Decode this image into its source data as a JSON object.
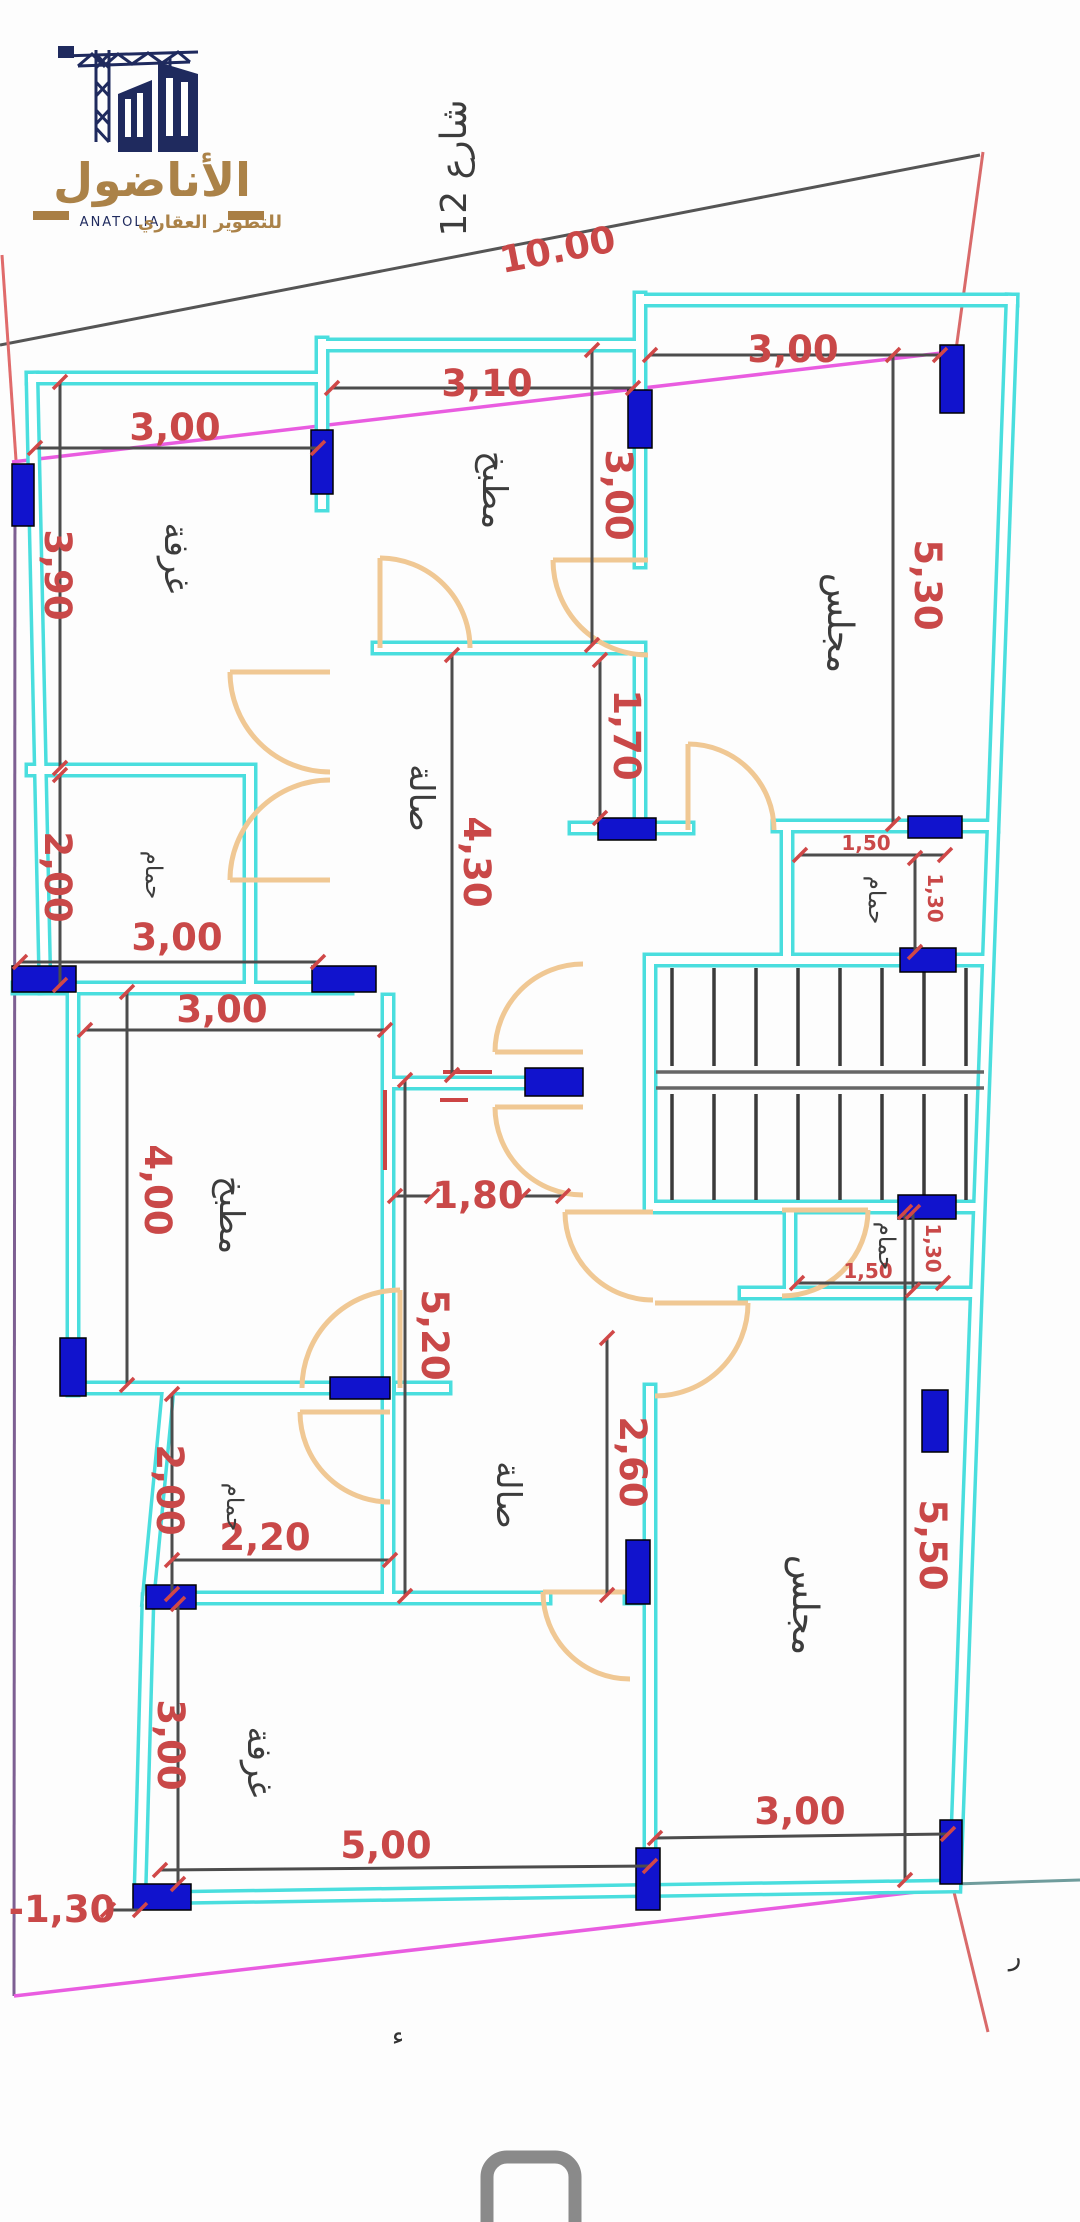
{
  "logo": {
    "brand_ar": "الأناضول",
    "tagline_ar": "للتطوير العقاري",
    "brand_en": "ANATOLIA"
  },
  "street": {
    "label": "شارع 12"
  },
  "colors": {
    "wall": "#4adede",
    "column": "#1113cd",
    "dimension_text": "#c94848",
    "dimension_line": "#4c4c4c",
    "door": "#f0c894",
    "boundary_magenta": "#e95ce0",
    "boundary_purple": "#7d5f92",
    "boundary_red": "#e06b6b",
    "navy": "#1f2a5e",
    "gold": "#ab8248"
  },
  "rooms": [
    {
      "id": "bedroom-top-left",
      "label": "غرفة"
    },
    {
      "id": "kitchen-top",
      "label": "مطبخ"
    },
    {
      "id": "majlis-top",
      "label": "مجلس"
    },
    {
      "id": "hall-upper",
      "label": "صالة"
    },
    {
      "id": "bath-upper-left",
      "label": "حمام"
    },
    {
      "id": "bath-upper-right",
      "label": "حمام"
    },
    {
      "id": "kitchen-lower",
      "label": "مطبخ"
    },
    {
      "id": "bath-lower-left",
      "label": "حمام"
    },
    {
      "id": "hall-lower",
      "label": "صالة"
    },
    {
      "id": "bath-lower-right",
      "label": "حمام"
    },
    {
      "id": "bedroom-bottom",
      "label": "غرفة"
    },
    {
      "id": "majlis-bottom",
      "label": "مجلس"
    }
  ],
  "dims": [
    {
      "id": "street-frontage",
      "label": "10.00"
    },
    {
      "id": "bedroom-tl-width",
      "label": "3,00"
    },
    {
      "id": "kitchen-top-width",
      "label": "3,10"
    },
    {
      "id": "majlis-top-width",
      "label": "3,00"
    },
    {
      "id": "majlis-top-height",
      "label": "5,30"
    },
    {
      "id": "bedroom-tl-height",
      "label": "3,90"
    },
    {
      "id": "kitchen-top-height",
      "label": "3,00"
    },
    {
      "id": "hall-majlis-gap",
      "label": "1,70"
    },
    {
      "id": "hall-upper-height",
      "label": "4,30"
    },
    {
      "id": "bath-ul-height",
      "label": "2,00"
    },
    {
      "id": "left-wall-width",
      "label": "3,00"
    },
    {
      "id": "kitchen-lower-width",
      "label": "3,00"
    },
    {
      "id": "kitchen-lower-height",
      "label": "4,00"
    },
    {
      "id": "corridor-width",
      "label": "1,80"
    },
    {
      "id": "hall-lower-height",
      "label": "5,20"
    },
    {
      "id": "hall-lower-right-height",
      "label": "2,60"
    },
    {
      "id": "bath-ll-height",
      "label": "2,00"
    },
    {
      "id": "bath-ll-width",
      "label": "2,20"
    },
    {
      "id": "majlis-bottom-height",
      "label": "5,50"
    },
    {
      "id": "bedroom-b-height",
      "label": "3,00"
    },
    {
      "id": "bedroom-b-width",
      "label": "5,00"
    },
    {
      "id": "majlis-bottom-width",
      "label": "3,00"
    },
    {
      "id": "setback",
      "label": "-1,30"
    },
    {
      "id": "bath-ur-width",
      "label": "1,50"
    },
    {
      "id": "bath-ur-height",
      "label": "1,30"
    },
    {
      "id": "bath-lr-width",
      "label": "1,50"
    },
    {
      "id": "bath-lr-height",
      "label": "1,30"
    }
  ],
  "marks": [
    {
      "id": "stray-mark-1",
      "label": "ء"
    },
    {
      "id": "stray-mark-2",
      "label": "ر"
    }
  ]
}
